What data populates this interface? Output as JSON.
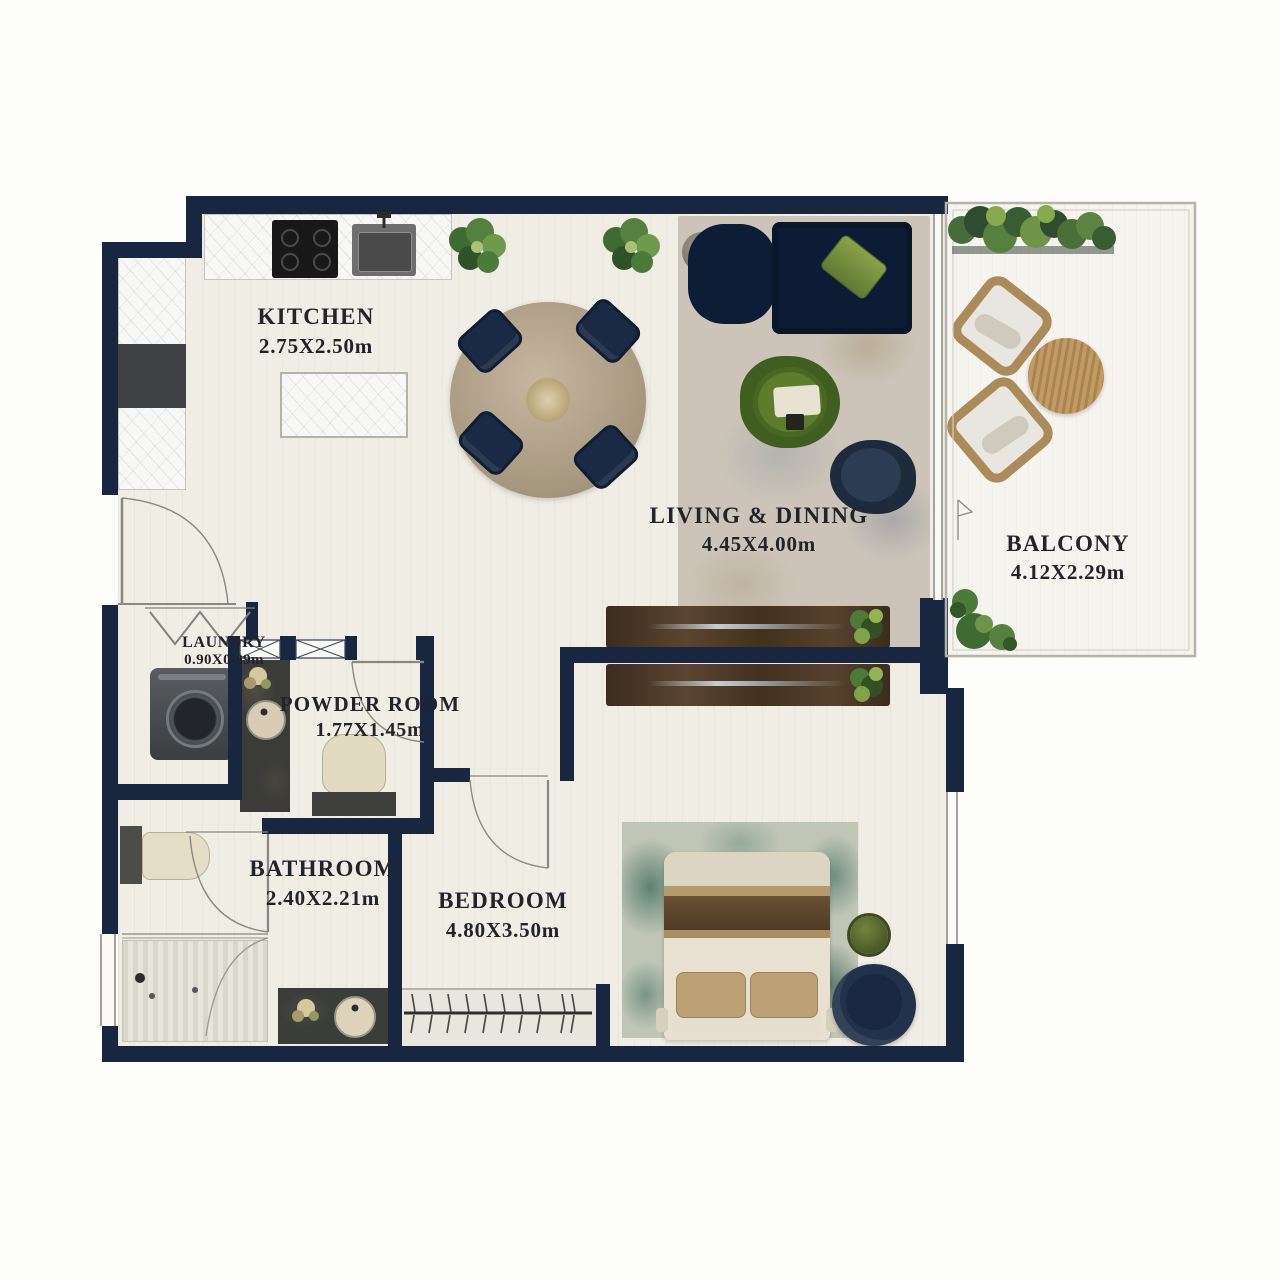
{
  "plan_title": "One-bedroom apartment floor plan",
  "rooms": [
    {
      "id": "kitchen",
      "name": "KITCHEN",
      "dims": "2.75X2.50m"
    },
    {
      "id": "living",
      "name": "LIVING & DINING",
      "dims": "4.45X4.00m"
    },
    {
      "id": "balcony",
      "name": "BALCONY",
      "dims": "4.12X2.29m"
    },
    {
      "id": "laundry",
      "name": "LAUNDRY",
      "dims": "0.90X0.89m"
    },
    {
      "id": "powder",
      "name": "POWDER ROOM",
      "dims": "1.77X1.45m"
    },
    {
      "id": "bathroom",
      "name": "BATHROOM",
      "dims": "2.40X2.21m"
    },
    {
      "id": "bedroom",
      "name": "BEDROOM",
      "dims": "4.80X3.50m"
    }
  ],
  "colors": {
    "wall": "#18273f",
    "floor": "#f0ede5",
    "balcony_floor": "#f6f4ee",
    "marble": "#f7f7f6",
    "sofa_navy": "#0e1d36",
    "wood_console": "#4a3526",
    "accent_green": "#4e7326",
    "rug_living": "#ccc4b8",
    "rug_bedroom": "#b7c0b0",
    "bed_linen": "#e8e1d2",
    "tan": "#b49a6d"
  },
  "furniture_icons": [
    "cooktop",
    "kitchen-sink",
    "fridge",
    "kitchen-island",
    "dining-table",
    "dining-chair",
    "plant",
    "sofa",
    "sofa-pillow",
    "side-table",
    "coffee-table",
    "armchair",
    "console-table",
    "balcony-planter",
    "outdoor-chair",
    "outdoor-table",
    "bush",
    "washing-machine",
    "bifold-door",
    "vanity",
    "vanity-sink",
    "toilet",
    "shower",
    "bed",
    "bed-pillow",
    "bed-runner",
    "bedside-table",
    "swivel-chair",
    "wardrobe-hangers",
    "door-swing",
    "window"
  ]
}
